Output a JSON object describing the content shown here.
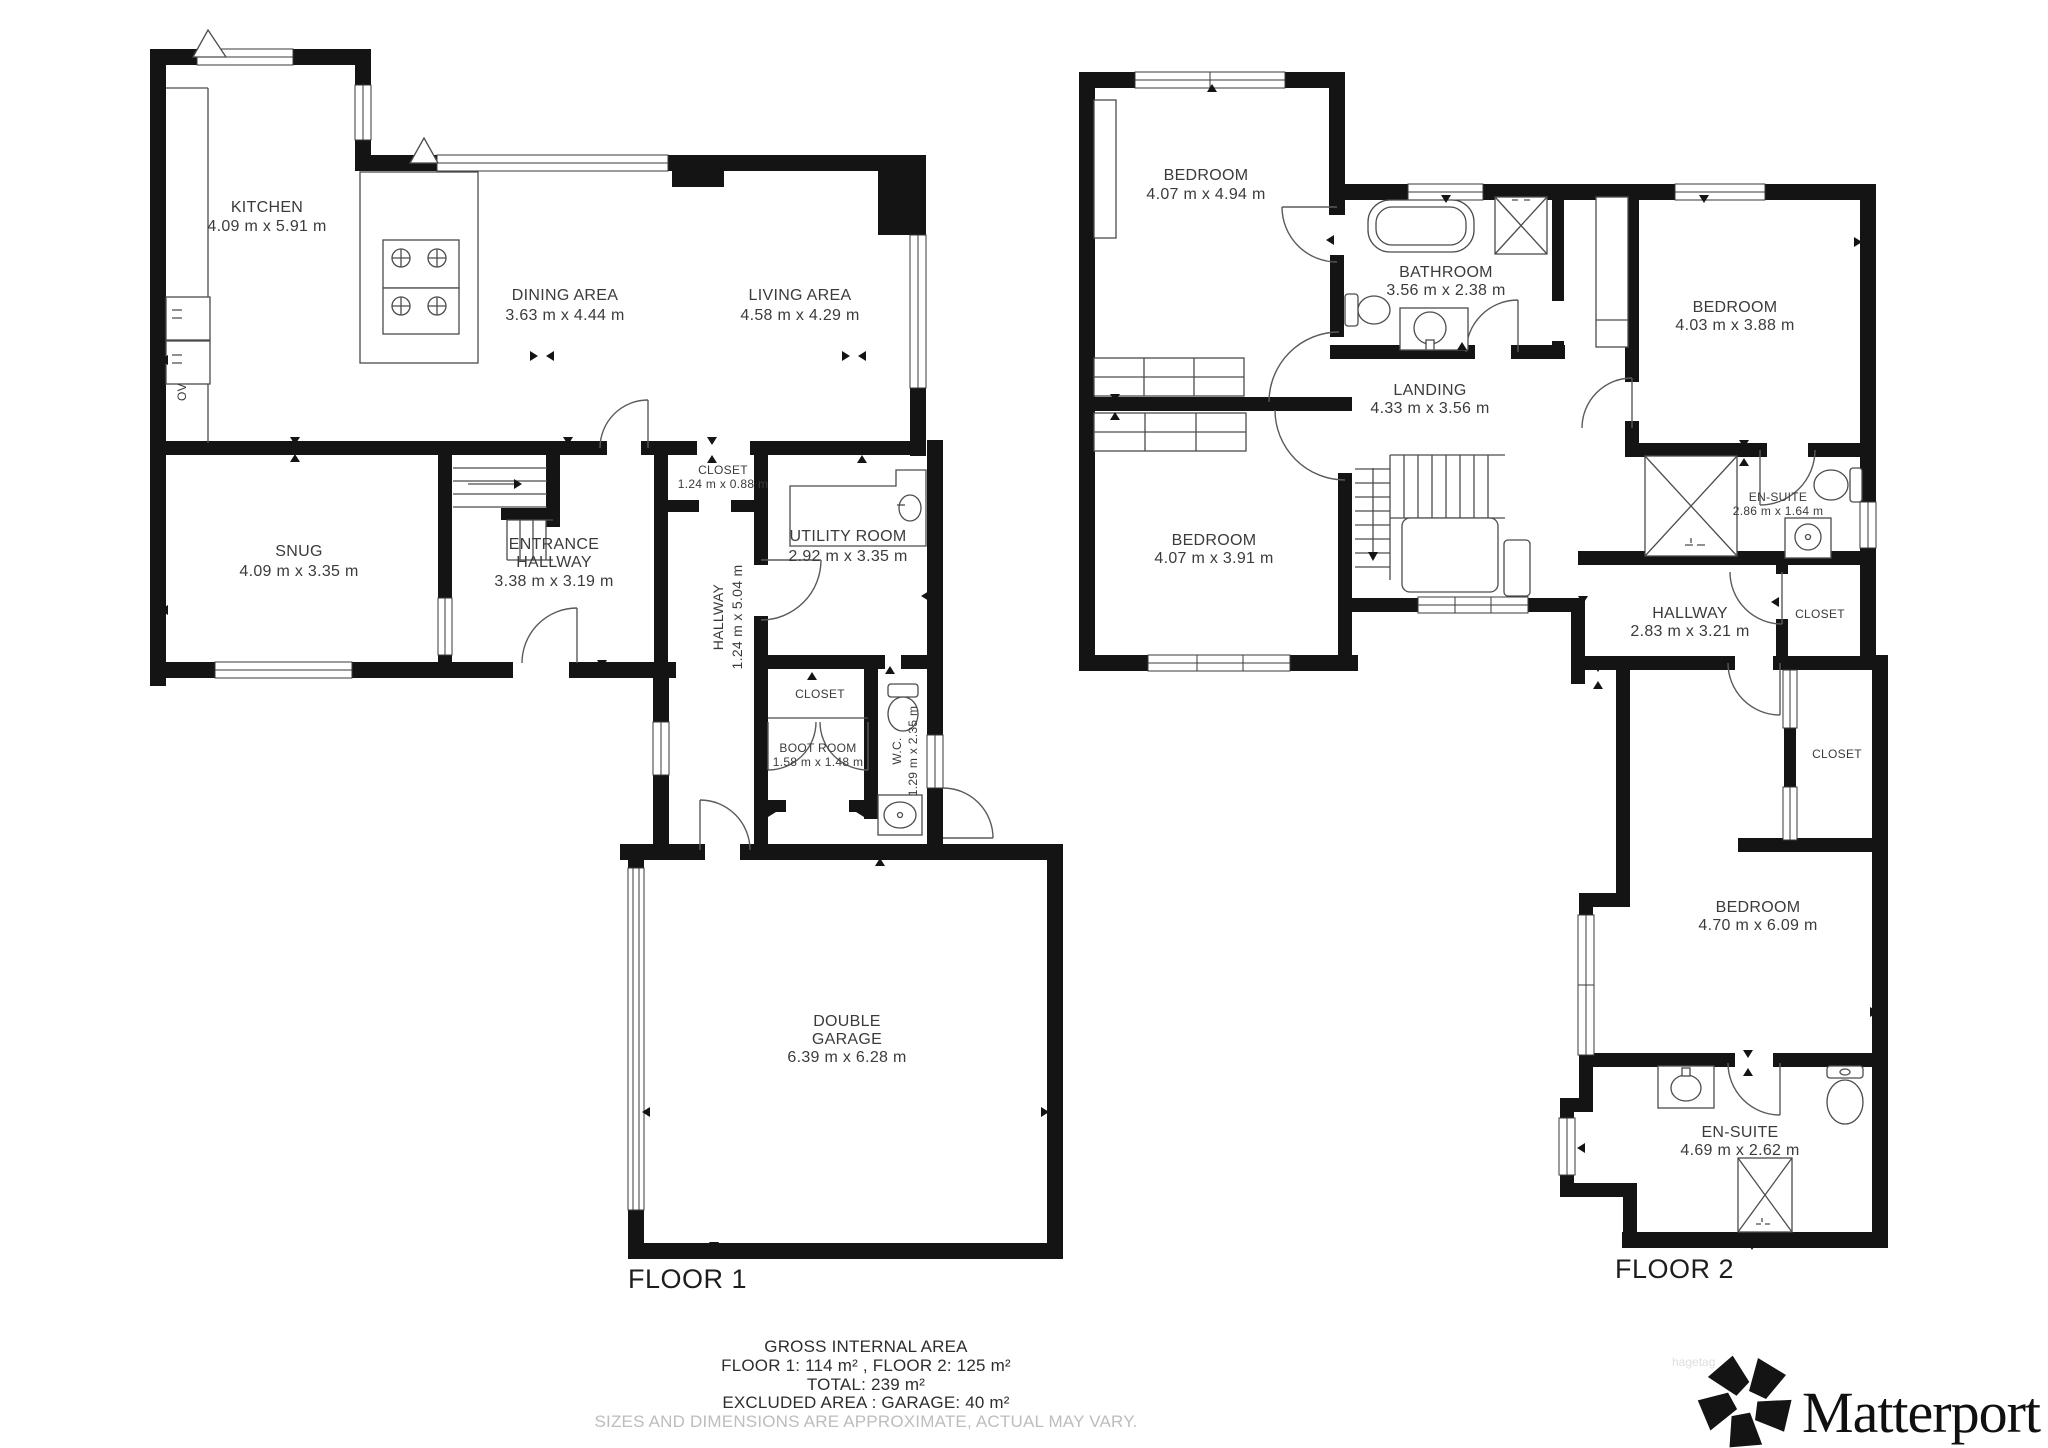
{
  "floor1": {
    "label": "FLOOR 1",
    "kitchen": {
      "name": "KITCHEN",
      "dims": "4.09 m x 5.91 m"
    },
    "dining": {
      "name": "DINING AREA",
      "dims": "3.63 m x 4.44 m"
    },
    "living": {
      "name": "LIVING AREA",
      "dims": "4.58 m x 4.29 m"
    },
    "snug": {
      "name": "SNUG",
      "dims": "4.09 m x 3.35 m"
    },
    "entrance": {
      "name1": "ENTRANCE",
      "name2": "HALLWAY",
      "dims": "3.38 m x 3.19 m"
    },
    "closet_top": {
      "name": "CLOSET",
      "dims": "1.24 m x 0.88 m"
    },
    "utility": {
      "name": "UTILITY ROOM",
      "dims": "2.92 m x 3.35 m"
    },
    "hallway": {
      "name": "HALLWAY",
      "dims": "1.24 m x 5.04 m"
    },
    "closet_mid": {
      "name": "CLOSET"
    },
    "bootroom": {
      "name": "BOOT ROOM",
      "dims": "1.58 m x 1.48 m"
    },
    "wc": {
      "name": "W.C.",
      "dims": "1.29 m x 2.35 m"
    },
    "garage": {
      "name1": "DOUBLE",
      "name2": "GARAGE",
      "dims": "6.39 m x 6.28 m"
    },
    "oven": "OV"
  },
  "floor2": {
    "label": "FLOOR 2",
    "bedroom1": {
      "name": "BEDROOM",
      "dims": "4.07 m x 4.94 m"
    },
    "bathroom": {
      "name": "BATHROOM",
      "dims": "3.56 m x 2.38 m"
    },
    "bedroom2": {
      "name": "BEDROOM",
      "dims": "4.03 m x 3.88 m"
    },
    "landing": {
      "name": "LANDING",
      "dims": "4.33 m x 3.56 m"
    },
    "bedroom3": {
      "name": "BEDROOM",
      "dims": "4.07 m x 3.91 m"
    },
    "ensuite1": {
      "name": "EN-SUITE",
      "dims": "2.86 m x 1.64 m"
    },
    "hallway2": {
      "name": "HALLWAY",
      "dims": "2.83 m x 3.21 m"
    },
    "closet_a": {
      "name": "CLOSET"
    },
    "closet_b": {
      "name": "CLOSET"
    },
    "bedroom4": {
      "name": "BEDROOM",
      "dims": "4.70 m x 6.09 m"
    },
    "ensuite2": {
      "name": "EN-SUITE",
      "dims": "4.69 m x 2.62 m"
    }
  },
  "footer": {
    "line1": "GROSS INTERNAL AREA",
    "line2": "FLOOR 1: 114 m² , FLOOR 2: 125 m²",
    "line3": "TOTAL: 239 m²",
    "line4": "EXCLUDED AREA : GARAGE: 40 m²",
    "disclaimer": "SIZES AND DIMENSIONS ARE APPROXIMATE, ACTUAL MAY VARY."
  },
  "brand": {
    "name": "Matterport",
    "watermark": "hagetag"
  },
  "colors": {
    "wall": "#141414",
    "label": "#3b3b3b",
    "disclaimer": "#bdbdbd"
  }
}
